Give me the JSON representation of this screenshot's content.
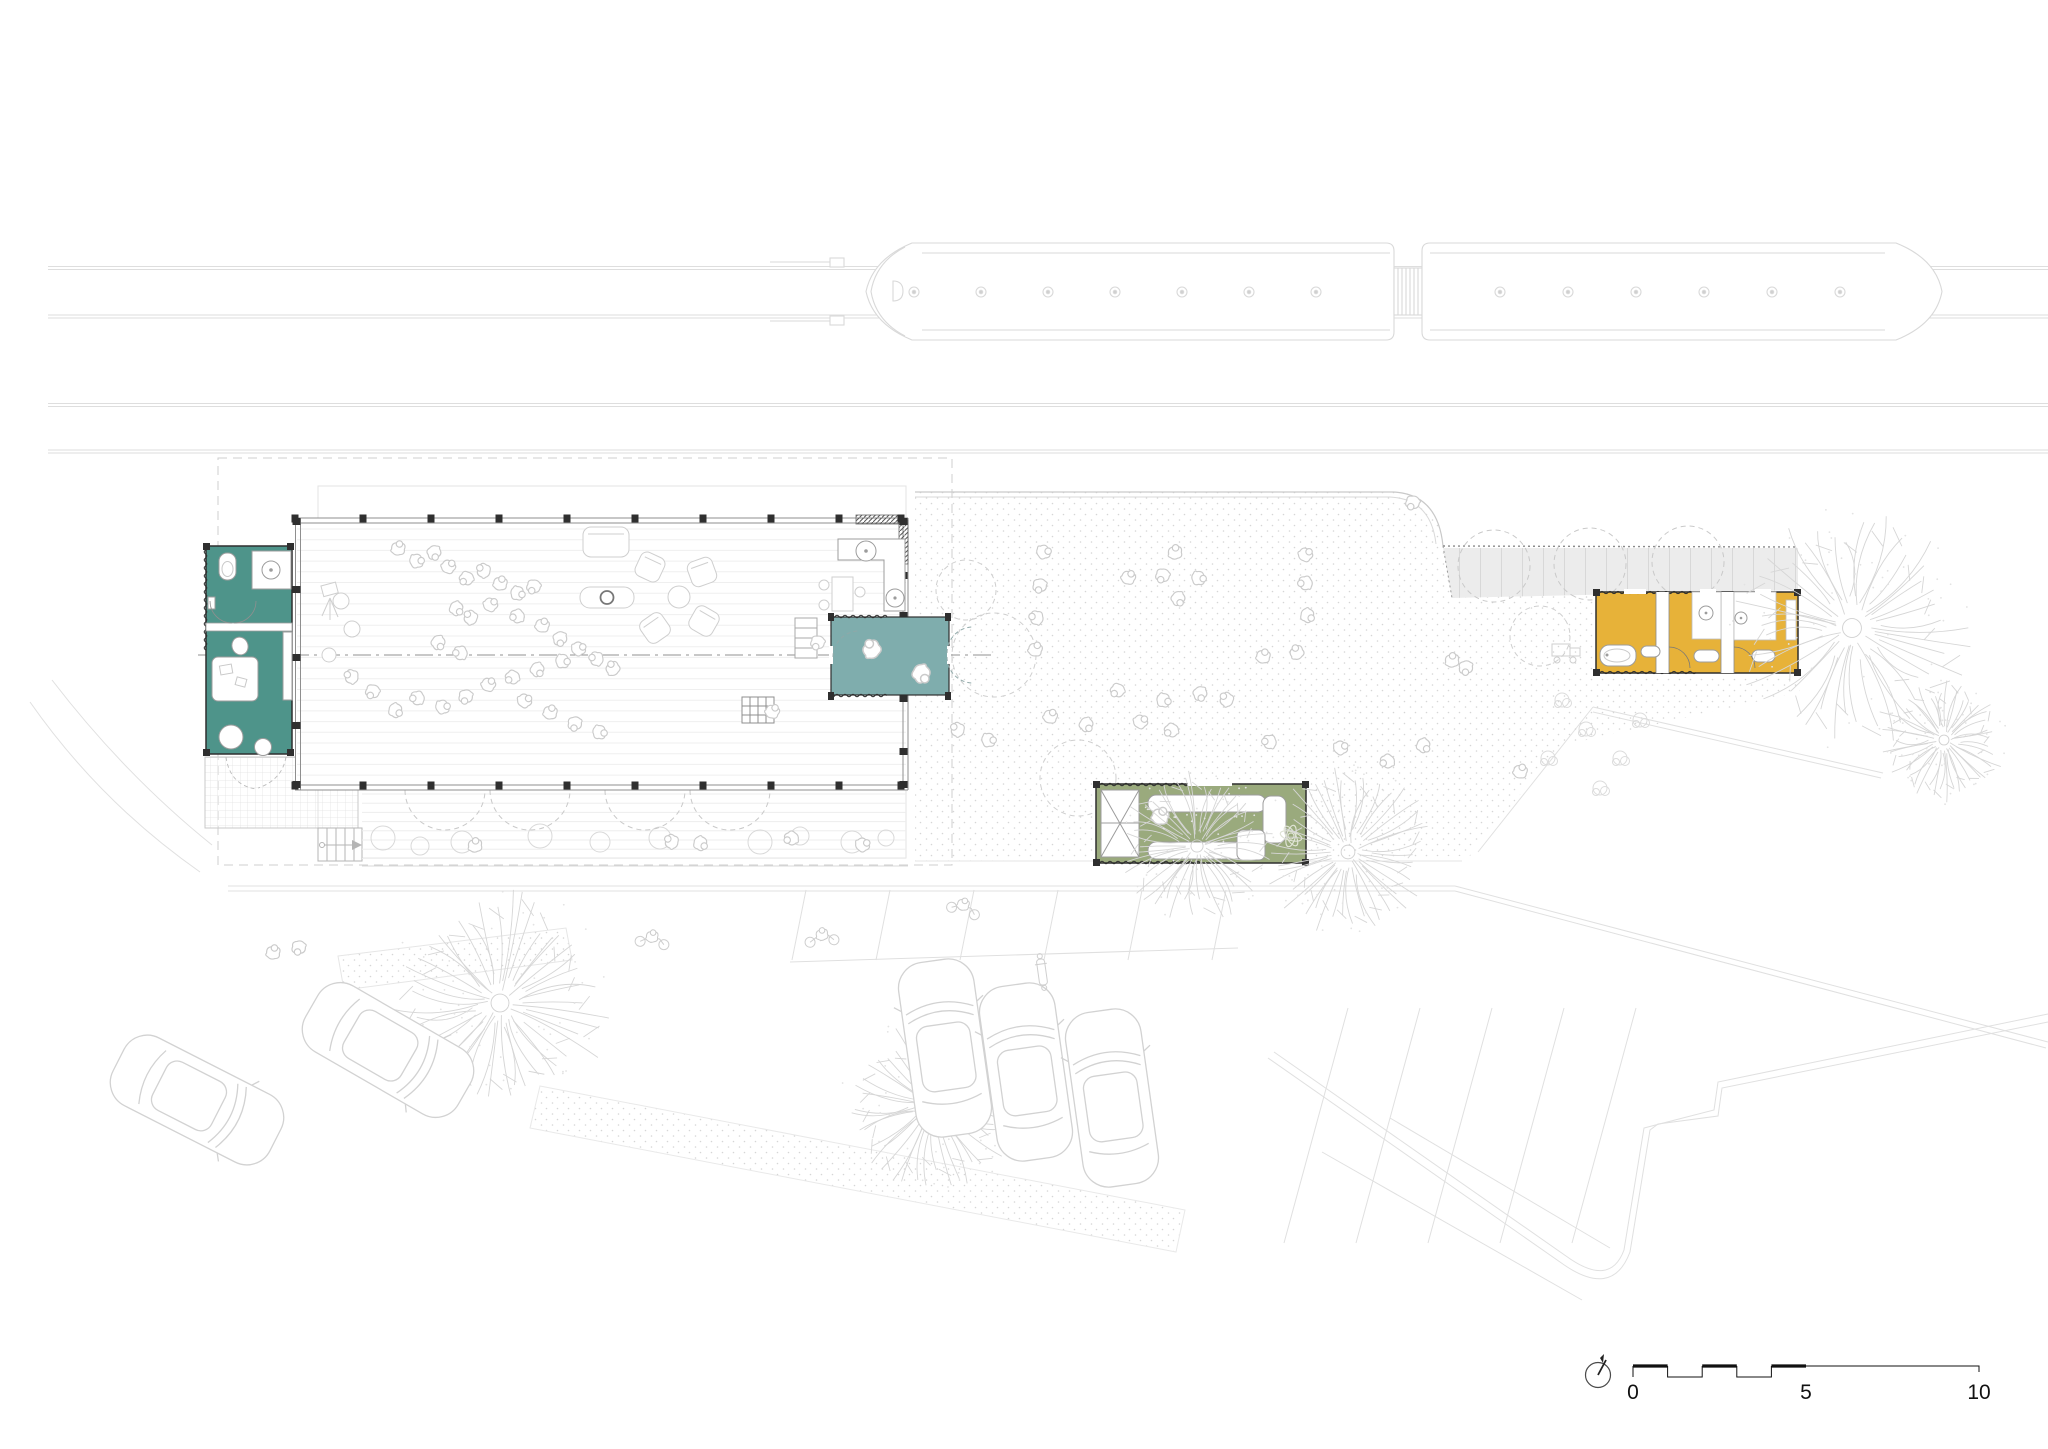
{
  "drawing": {
    "type": "architectural-site-plan",
    "scale_bar": {
      "label_0": "0",
      "label_5": "5",
      "label_10": "10"
    },
    "colors": {
      "paper": "#ffffff",
      "container_left_teal": "#4E948A",
      "container_mid_teal": "#7FADAD",
      "container_green": "#9AAA7D",
      "container_yellow": "#E7B239",
      "canopy_gray": "#ECECEC",
      "wall_dark": "#2F2F2F",
      "line_faint": "#DEDEDE",
      "line_light": "#CFCFCF",
      "line_mid": "#9A9A9A",
      "stipple_dot": "#D6D6D6",
      "ink": "#111111"
    }
  }
}
